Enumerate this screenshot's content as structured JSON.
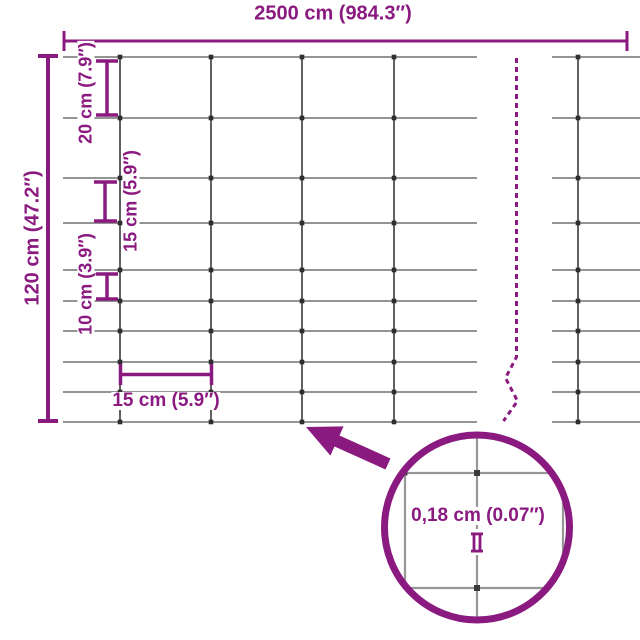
{
  "diagram_type": "fence-mesh-dimension-diagram",
  "labels": {
    "total_width": "2500 cm (984.3″)",
    "total_height": "120 cm (47.2″)",
    "row_spacing_top": "20 cm (7.9″)",
    "row_spacing_middle": "15 cm (5.9″)",
    "row_spacing_lower": "10 cm (3.9″)",
    "column_spacing": "15 cm (5.9″)",
    "wire_thickness": "0,18 cm (0.07″)"
  },
  "mesh": {
    "total_width_cm": 2500,
    "total_height_cm": 120,
    "horizontal_wire_count": 10,
    "row_spacings_cm": [
      20,
      20,
      15,
      15,
      10,
      10,
      10,
      10,
      10
    ],
    "column_spacing_cm": 15,
    "wire_thickness_cm": 0.18
  },
  "icons": {
    "arrow": "magnifier-pointer-arrow",
    "magnifier": "magnifier-circle",
    "gauge": "wire-gauge-symbol",
    "break": "length-break-dashed-line"
  },
  "colors": {
    "accent": "#8b1a80",
    "wire_horizontal": "#858585",
    "wire_vertical": "#4f4f4f",
    "junction": "#2e2e2e",
    "magnifier_line": "#979797",
    "background": "#ffffff"
  }
}
